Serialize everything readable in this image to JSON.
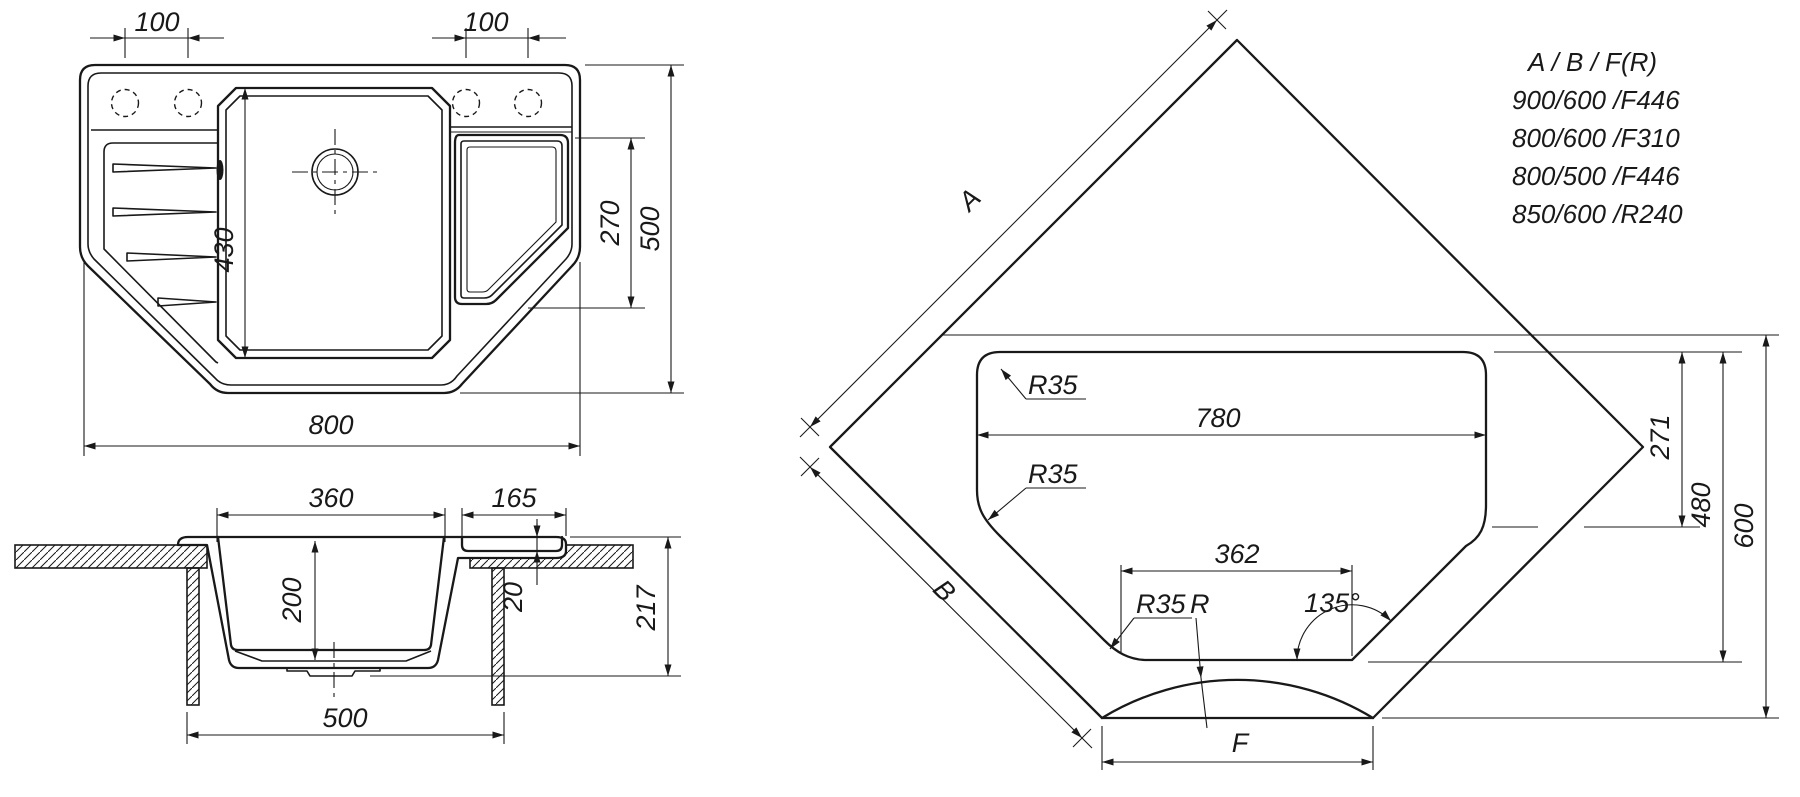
{
  "title": "Corner kitchen sink technical drawing",
  "colors": {
    "line": "#191919",
    "background": "#ffffff"
  },
  "top_view": {
    "dim_hole_spacing_left": "100",
    "dim_hole_spacing_right": "100",
    "dim_main_bowl_length": "430",
    "dim_small_bowl_length": "270",
    "dim_overall_depth": "500",
    "dim_overall_width": "800"
  },
  "section_view": {
    "dim_bowl_top_width": "360",
    "dim_small_bowl_width": "165",
    "dim_bowl_depth": "200",
    "dim_lip_depth": "20",
    "dim_total_height": "217",
    "dim_cabinet_width": "500"
  },
  "corner_view": {
    "dim_edge_a": "A",
    "dim_edge_b": "B",
    "dim_front_width": "F",
    "dim_cutout_width": "780",
    "dim_bottom_width": "362",
    "dim_corner_radius_top": "R35",
    "dim_corner_radius_left": "R35",
    "dim_corner_radius_bottom": "R35",
    "dim_front_radius": "R",
    "dim_angle": "135°",
    "dim_right_inset": "271",
    "dim_cutout_depth": "480",
    "dim_overall_depth": "600",
    "size_table": {
      "header": "A / B / F(R)",
      "rows": [
        "900/600 /F446",
        "800/600 /F310",
        "800/500 /F446",
        "850/600 /R240"
      ]
    }
  }
}
